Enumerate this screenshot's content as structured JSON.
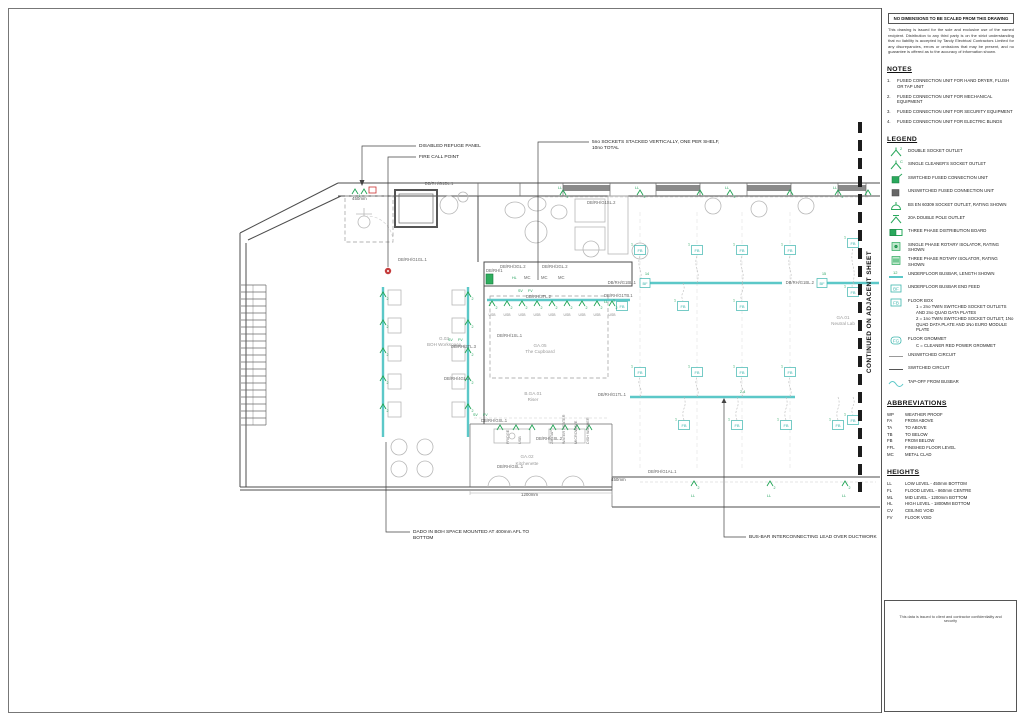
{
  "sheet": {
    "disclaimer_title": "NO DIMENSIONS TO BE SCALED FROM THIS DRAWING",
    "disclaimer_body": "This drawing is issued for the sole and exclusive use of the named recipient. Distribution to any third party is on the strict understanding that no liability is accepted by Tandy Electrical Contractors Limited for any discrepancies, errors or omissions that may be present, and no guarantee is offered as to the accuracy of information shown.",
    "continued_label": "CONTINUED ON ADJACENT SHEET",
    "footer_note": "This data is issued to client and contractor confidentiality and security"
  },
  "notes": {
    "title": "NOTES",
    "items": [
      "FUSED CONNECTION UNIT FOR HAND DRYER, FLUSH OR TAP UNIT",
      "FUSED CONNECTION UNIT FOR MECHANICAL EQUIPMENT",
      "FUSED CONNECTION UNIT FOR SECURITY EQUIPMENT",
      "FUSED CONNECTION UNIT FOR ELECTRIC BLINDS"
    ]
  },
  "legend": {
    "title": "LEGEND",
    "items": [
      {
        "icon": "double-socket-outlet-icon",
        "sym": "2",
        "label": "DOUBLE SOCKET OUTLET"
      },
      {
        "icon": "cleaners-socket-outlet-icon",
        "sym": "C",
        "label": "SINGLE CLEANER'S SOCKET OUTLET"
      },
      {
        "icon": "switched-fcu-icon",
        "sym": "",
        "label": "SWITCHED FUSED CONNECTION UNIT"
      },
      {
        "icon": "unswitched-fcu-icon",
        "sym": "",
        "label": "UNSWITCHED FUSED CONNECTION UNIT"
      },
      {
        "icon": "bs-en-socket-icon",
        "sym": "",
        "label": "BS EN 60309 SOCKET OUTLET, RATING SHOWN"
      },
      {
        "icon": "dp-outlet-icon",
        "sym": "",
        "label": "20A DOUBLE POLE OUTLET"
      },
      {
        "icon": "tp-db-icon",
        "sym": "",
        "label": "THREE PHASE DISTRIBUTION BOARD"
      },
      {
        "icon": "sp-isolator-icon",
        "sym": "",
        "label": "SINGLE PHASE ROTARY ISOLATOR, RATING SHOWN"
      },
      {
        "icon": "tp-isolator-icon",
        "sym": "",
        "label": "THREE PHASE ROTARY ISOLATOR, RATING SHOWN"
      },
      {
        "icon": "busbar-icon",
        "sym": "12",
        "label": "UNDERFLOOR BUSBAR, LENGTH SHOWN"
      },
      {
        "icon": "busbar-end-feed-icon",
        "sym": "BF",
        "label": "UNDERFLOOR BUSBAR END FEED"
      },
      {
        "icon": "floor-box-icon",
        "sym": "FB",
        "label": "FLOOR BOX",
        "sub": [
          "1 = 2no TWIN SWITCHED SOCKET OUTLETS AND 2no QUAD DATA PLATES",
          "2 = 1no TWIN SWITCHED SOCKET OUTLET, 1No QUAD DATA PLATE AND 1No EURO MODULE PLATE"
        ]
      },
      {
        "icon": "floor-grommet-icon",
        "sym": "FG",
        "label": "FLOOR GROMMET",
        "sub": [
          "C = CLEANER RED POWER GROMMET"
        ]
      },
      {
        "icon": "unswitched-circuit-icon",
        "sym": "",
        "label": "UNSWITCHED CIRCUIT"
      },
      {
        "icon": "switched-circuit-icon",
        "sym": "",
        "label": "SWITCHED CIRCUIT"
      },
      {
        "icon": "tap-off-icon",
        "sym": "",
        "label": "TAP-OFF FROM BUSBAR"
      }
    ]
  },
  "abbreviations": {
    "title": "ABBREVIATIONS",
    "items": [
      {
        "code": "WP",
        "meaning": "WEATHER PROOF"
      },
      {
        "code": "FA",
        "meaning": "FROM ABOVE"
      },
      {
        "code": "TA",
        "meaning": "TO ABOVE"
      },
      {
        "code": "TB",
        "meaning": "TO BELOW"
      },
      {
        "code": "FB",
        "meaning": "FROM BELOW"
      },
      {
        "code": "FFL",
        "meaning": "FINISHED FLOOR LEVEL"
      },
      {
        "code": "MC",
        "meaning": "METAL CLAD"
      }
    ]
  },
  "heights": {
    "title": "HEIGHTS",
    "items": [
      {
        "code": "LL",
        "meaning": "LOW LEVEL - 450mm BOTTOM"
      },
      {
        "code": "FL",
        "meaning": "FLOOD LEVEL - 860mm CENTRE"
      },
      {
        "code": "ML",
        "meaning": "MID LEVEL - 1200mm BOTTOM"
      },
      {
        "code": "HL",
        "meaning": "HIGH LEVEL - 1800MM BOTTOM"
      },
      {
        "code": "CV",
        "meaning": "CEILING VOID"
      },
      {
        "code": "FV",
        "meaning": "FLOOR VOID"
      }
    ]
  },
  "plan": {
    "floor_box_label": "FB",
    "busbar_feed_label": "BF",
    "colors": {
      "busbar": "#5cc8c8",
      "symbol_green": "#21a455",
      "fire_red": "#cc3333"
    },
    "busbars": [
      {
        "x1": 487,
        "y1": 300,
        "x2": 630,
        "y2": 300
      },
      {
        "x1": 650,
        "y1": 283,
        "x2": 782,
        "y2": 283
      },
      {
        "x1": 827,
        "y1": 283,
        "x2": 879,
        "y2": 283
      },
      {
        "x1": 630,
        "y1": 397,
        "x2": 795,
        "y2": 397
      },
      {
        "x1": 383,
        "y1": 287,
        "x2": 383,
        "y2": 437
      },
      {
        "x1": 468,
        "y1": 287,
        "x2": 468,
        "y2": 437
      }
    ],
    "busbar_feeds": [
      {
        "x": 645,
        "y": 283
      },
      {
        "x": 822,
        "y": 283
      }
    ],
    "floor_boxes": [
      {
        "x": 640,
        "y": 250,
        "from": 283
      },
      {
        "x": 697,
        "y": 250,
        "from": 283
      },
      {
        "x": 742,
        "y": 250,
        "from": 283
      },
      {
        "x": 790,
        "y": 250,
        "from": 283
      },
      {
        "x": 622,
        "y": 306,
        "from": 306
      },
      {
        "x": 683,
        "y": 306,
        "from": 283
      },
      {
        "x": 742,
        "y": 306,
        "from": 283
      },
      {
        "x": 640,
        "y": 372,
        "from": 397
      },
      {
        "x": 697,
        "y": 372,
        "from": 397
      },
      {
        "x": 742,
        "y": 372,
        "from": 397
      },
      {
        "x": 790,
        "y": 372,
        "from": 397
      },
      {
        "x": 684,
        "y": 425,
        "from": 397
      },
      {
        "x": 737,
        "y": 425,
        "from": 397
      },
      {
        "x": 786,
        "y": 425,
        "from": 397
      },
      {
        "x": 838,
        "y": 425,
        "from": 397
      },
      {
        "x": 853,
        "y": 243,
        "from": 283
      },
      {
        "x": 853,
        "y": 292,
        "from": 283
      },
      {
        "x": 853,
        "y": 420,
        "from": 397
      }
    ],
    "sockets": [
      {
        "x": 563,
        "y": 193,
        "n": "2"
      },
      {
        "x": 640,
        "y": 193,
        "n": "2"
      },
      {
        "x": 700,
        "y": 193
      },
      {
        "x": 730,
        "y": 193,
        "n": "2"
      },
      {
        "x": 790,
        "y": 193
      },
      {
        "x": 838,
        "y": 193,
        "n": "2"
      },
      {
        "x": 868,
        "y": 193
      },
      {
        "x": 355,
        "y": 192,
        "n": "1"
      },
      {
        "x": 364,
        "y": 192
      },
      {
        "x": 383,
        "y": 295,
        "n": "2"
      },
      {
        "x": 383,
        "y": 323,
        "n": "2"
      },
      {
        "x": 383,
        "y": 351,
        "n": "2"
      },
      {
        "x": 383,
        "y": 379,
        "n": "2"
      },
      {
        "x": 383,
        "y": 407,
        "n": "2"
      },
      {
        "x": 468,
        "y": 295,
        "n": "2"
      },
      {
        "x": 468,
        "y": 323,
        "n": "2"
      },
      {
        "x": 468,
        "y": 351,
        "n": "2"
      },
      {
        "x": 468,
        "y": 379,
        "n": "2"
      },
      {
        "x": 468,
        "y": 407,
        "n": "2"
      },
      {
        "x": 492,
        "y": 304,
        "n": "2"
      },
      {
        "x": 507,
        "y": 304,
        "n": "2"
      },
      {
        "x": 522,
        "y": 304,
        "n": "2"
      },
      {
        "x": 537,
        "y": 304,
        "n": "2"
      },
      {
        "x": 552,
        "y": 304,
        "n": "2"
      },
      {
        "x": 567,
        "y": 304,
        "n": "2"
      },
      {
        "x": 582,
        "y": 304,
        "n": "2"
      },
      {
        "x": 597,
        "y": 304,
        "n": "2"
      },
      {
        "x": 612,
        "y": 304,
        "n": "2"
      },
      {
        "x": 694,
        "y": 484,
        "n": "2"
      },
      {
        "x": 770,
        "y": 484,
        "n": "2"
      },
      {
        "x": 845,
        "y": 484,
        "n": "2"
      },
      {
        "x": 500,
        "y": 428
      },
      {
        "x": 516,
        "y": 428
      },
      {
        "x": 532,
        "y": 428
      },
      {
        "x": 553,
        "y": 428
      },
      {
        "x": 565,
        "y": 428
      },
      {
        "x": 577,
        "y": 428
      },
      {
        "x": 589,
        "y": 428
      }
    ],
    "annotations": [
      {
        "x": 352,
        "y": 200,
        "t": "450mm",
        "c": "dim"
      },
      {
        "x": 439,
        "y": 185,
        "t": "DB/RH/G1DL.1",
        "c": "db",
        "a": "middle"
      },
      {
        "x": 587,
        "y": 204,
        "t": "DB/RH/G1SL.2",
        "c": "db"
      },
      {
        "x": 398,
        "y": 261,
        "t": "DB/RH/G1GL.1",
        "c": "db"
      },
      {
        "x": 500,
        "y": 268,
        "t": "DB/RH/3GL.2",
        "c": "db"
      },
      {
        "x": 542,
        "y": 268,
        "t": "DB/RH/2GL.2",
        "c": "db"
      },
      {
        "x": 486,
        "y": 272,
        "t": "DB/RH/1",
        "c": "db"
      },
      {
        "x": 512,
        "y": 279,
        "t": "HL",
        "c": "green"
      },
      {
        "x": 524,
        "y": 279,
        "t": "MC",
        "c": "db"
      },
      {
        "x": 541,
        "y": 279,
        "t": "MC",
        "c": "db"
      },
      {
        "x": 558,
        "y": 279,
        "t": "MC",
        "c": "db"
      },
      {
        "x": 518,
        "y": 292,
        "t": "SV",
        "c": "green"
      },
      {
        "x": 528,
        "y": 292,
        "t": "FV",
        "c": "green"
      },
      {
        "x": 526,
        "y": 298,
        "t": "DB/RH/3TL.2",
        "c": "db"
      },
      {
        "x": 497,
        "y": 337,
        "t": "DB/RH/1SL.1",
        "c": "db"
      },
      {
        "x": 448,
        "y": 341,
        "t": "SV",
        "c": "green"
      },
      {
        "x": 458,
        "y": 341,
        "t": "FV",
        "c": "green"
      },
      {
        "x": 451,
        "y": 348,
        "t": "DB/RH/3TL.3",
        "c": "db"
      },
      {
        "x": 444,
        "y": 380,
        "t": "DB/RH/4GL.2",
        "c": "db"
      },
      {
        "x": 636,
        "y": 284,
        "t": "DB/RH/G1BL.1",
        "c": "db",
        "a": "end"
      },
      {
        "x": 645,
        "y": 275,
        "t": "14",
        "c": "green"
      },
      {
        "x": 604,
        "y": 297,
        "t": "DB/RH/G1TB.1",
        "c": "db"
      },
      {
        "x": 604,
        "y": 303,
        "t": "LL",
        "c": "green"
      },
      {
        "x": 814,
        "y": 284,
        "t": "DB/RH/G1BL.2",
        "c": "db",
        "a": "end"
      },
      {
        "x": 822,
        "y": 275,
        "t": "15",
        "c": "green"
      },
      {
        "x": 626,
        "y": 396,
        "t": "DB/RH/G1TL.1",
        "c": "db",
        "a": "end"
      },
      {
        "x": 740,
        "y": 393,
        "t": "2-4",
        "c": "green"
      },
      {
        "x": 648,
        "y": 473,
        "t": "DB/RH/G1AL.1",
        "c": "db"
      },
      {
        "x": 473,
        "y": 416,
        "t": "SV",
        "c": "green"
      },
      {
        "x": 483,
        "y": 416,
        "t": "FV",
        "c": "green"
      },
      {
        "x": 481,
        "y": 422,
        "t": "DB/RH/GSL.1",
        "c": "db"
      },
      {
        "x": 536,
        "y": 440,
        "t": "DB/RH/GSL.2",
        "c": "db"
      },
      {
        "x": 497,
        "y": 468,
        "t": "DB/RH/GSL.1",
        "c": "db"
      },
      {
        "x": 611,
        "y": 481,
        "t": "450mm",
        "c": "dim"
      },
      {
        "x": 521,
        "y": 496,
        "t": "1200mm",
        "c": "dim"
      },
      {
        "x": 444,
        "y": 340,
        "t": "G.03",
        "c": "room",
        "a": "middle"
      },
      {
        "x": 444,
        "y": 346,
        "t": "BOH Workspace",
        "c": "room",
        "a": "middle"
      },
      {
        "x": 540,
        "y": 347,
        "t": "GA.05",
        "c": "room",
        "a": "middle"
      },
      {
        "x": 540,
        "y": 353,
        "t": "The Cupboard",
        "c": "room",
        "a": "middle"
      },
      {
        "x": 533,
        "y": 395,
        "t": "B.GA.01",
        "c": "room",
        "a": "middle"
      },
      {
        "x": 533,
        "y": 401,
        "t": "Riser",
        "c": "room",
        "a": "middle"
      },
      {
        "x": 527,
        "y": 458,
        "t": "GA.02",
        "c": "room",
        "a": "middle"
      },
      {
        "x": 527,
        "y": 465,
        "t": "Kitchenette",
        "c": "room",
        "a": "middle"
      },
      {
        "x": 843,
        "y": 319,
        "t": "GA.01",
        "c": "room",
        "a": "middle"
      },
      {
        "x": 843,
        "y": 325,
        "t": "Neutral Lab",
        "c": "room",
        "a": "middle"
      },
      {
        "x": 419,
        "y": 147,
        "t": "DISABLED REFUGE PANEL",
        "c": "callout"
      },
      {
        "x": 419,
        "y": 158,
        "t": "FIRE CALL POINT",
        "c": "callout"
      },
      {
        "x": 592,
        "y": 143,
        "t": "5no SOCKETS STACKED VERTICALLY, ONE PER SHELF,",
        "c": "callout"
      },
      {
        "x": 592,
        "y": 149,
        "t": "10no TOTAL",
        "c": "callout"
      },
      {
        "x": 413,
        "y": 533,
        "t": "DADO IN BOH SPACE MOUNTED AT 400mm AFL TO",
        "c": "callout"
      },
      {
        "x": 413,
        "y": 539,
        "t": "BOTTOM",
        "c": "callout"
      },
      {
        "x": 749,
        "y": 538,
        "t": "BUS-BAR INTERCONNECTING LEAD OVER DUCTWORK",
        "c": "callout"
      },
      {
        "x": 509,
        "y": 444,
        "t": "FRIDGE",
        "c": "vert",
        "rot": -90
      },
      {
        "x": 521,
        "y": 444,
        "t": "USB",
        "c": "vert",
        "rot": -90
      },
      {
        "x": 553,
        "y": 444,
        "t": "ZIP TAP",
        "c": "vert",
        "rot": -90
      },
      {
        "x": 565,
        "y": 444,
        "t": "WATER HEATER",
        "c": "vert",
        "rot": -90
      },
      {
        "x": 577,
        "y": 444,
        "t": "MICROWAVE",
        "c": "vert",
        "rot": -90
      },
      {
        "x": 589,
        "y": 444,
        "t": "DISH WASHER",
        "c": "vert",
        "rot": -90
      },
      {
        "x": 558,
        "y": 189,
        "t": "LL",
        "c": "green"
      },
      {
        "x": 635,
        "y": 189,
        "t": "LL",
        "c": "green"
      },
      {
        "x": 725,
        "y": 189,
        "t": "LL",
        "c": "green"
      },
      {
        "x": 833,
        "y": 189,
        "t": "LL",
        "c": "green"
      },
      {
        "x": 691,
        "y": 497,
        "t": "LL",
        "c": "green"
      },
      {
        "x": 767,
        "y": 497,
        "t": "LL",
        "c": "green"
      },
      {
        "x": 842,
        "y": 497,
        "t": "LL",
        "c": "green"
      },
      {
        "x": 492,
        "y": 316,
        "t": "USB",
        "c": "usb",
        "a": "middle"
      },
      {
        "x": 507,
        "y": 316,
        "t": "USB",
        "c": "usb",
        "a": "middle"
      },
      {
        "x": 522,
        "y": 316,
        "t": "USB",
        "c": "usb",
        "a": "middle"
      },
      {
        "x": 537,
        "y": 316,
        "t": "USB",
        "c": "usb",
        "a": "middle"
      },
      {
        "x": 552,
        "y": 316,
        "t": "USB",
        "c": "usb",
        "a": "middle"
      },
      {
        "x": 567,
        "y": 316,
        "t": "USB",
        "c": "usb",
        "a": "middle"
      },
      {
        "x": 582,
        "y": 316,
        "t": "USB",
        "c": "usb",
        "a": "middle"
      },
      {
        "x": 597,
        "y": 316,
        "t": "USB",
        "c": "usb",
        "a": "middle"
      },
      {
        "x": 612,
        "y": 316,
        "t": "USB",
        "c": "usb",
        "a": "middle"
      }
    ]
  }
}
